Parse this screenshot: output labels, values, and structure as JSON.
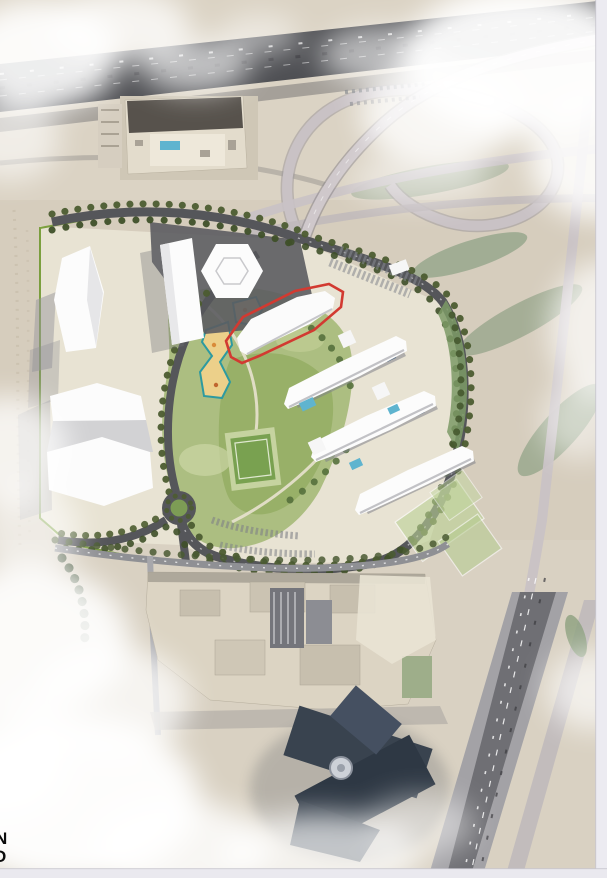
{
  "annotation": {
    "line1": "N",
    "line2": "D"
  },
  "colors": {
    "page_margin": "#eceaf0",
    "sand": "#d6cdbd",
    "sand_light": "#dbd3c4",
    "asphalt_dark": "#4e4f53",
    "ramp_gray": "#c9c2c5",
    "site_ground": "#e9e4d4",
    "building_white": "#fcfcfc",
    "shadow_gray": "#8f8f95",
    "park_green": "#a9bc7c",
    "park_green_dark": "#93ad62",
    "tree_green": "#4c5c30",
    "field_green": "#79a150",
    "playground_teal": "#2d9aa0",
    "playground_sand": "#ecd08a",
    "highlight_red": "#d23a31",
    "boundary_green": "#70982f",
    "water_blue": "#5fb4cf",
    "existing_roof_beige": "#dcd4c3",
    "dark_roof_blue": "#323c49",
    "highway_gray": "#a3a2a6",
    "cloud_white": "#ffffff"
  },
  "features": [
    {
      "name": "highway-interchange"
    },
    {
      "name": "red-highlighted-plot"
    },
    {
      "name": "residential-bar-buildings"
    },
    {
      "name": "hexagonal-tower"
    },
    {
      "name": "central-park"
    },
    {
      "name": "sports-field"
    },
    {
      "name": "playgrounds"
    },
    {
      "name": "roundabout"
    },
    {
      "name": "existing-mall-complex"
    },
    {
      "name": "clouds"
    }
  ]
}
